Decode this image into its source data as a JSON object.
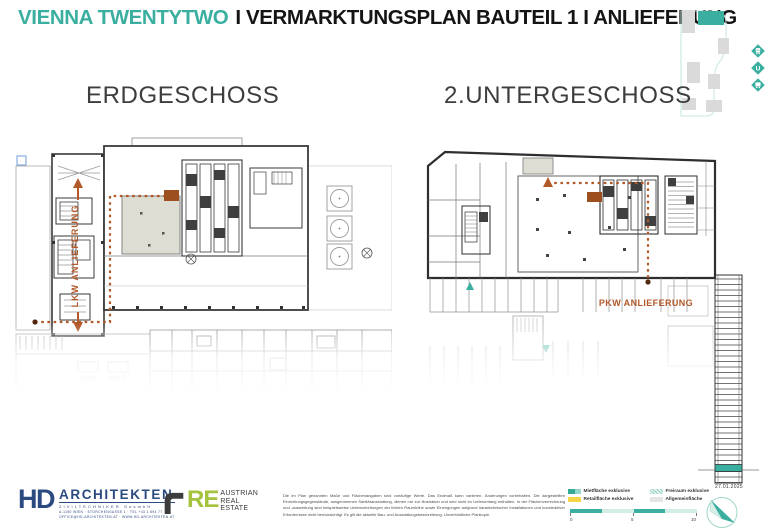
{
  "header": {
    "brand": "VIENNA TWENTYTWO",
    "title": "I VERMARKTUNGSPLAN BAUTEIL 1 I ANLIEFERUNG"
  },
  "site_map": {
    "ubahn_label": "U",
    "highlight_color": "#3aafa0"
  },
  "plans": {
    "left": {
      "title": "ERDGESCHOSS",
      "route_label": "LKW ANLIEFERUNG"
    },
    "right": {
      "title": "2.UNTERGESCHOSS",
      "route_label": "PKW ANLIEFERUNG"
    }
  },
  "route_color": "#b2592a",
  "level_indicator": {
    "date": "27.01.2025",
    "highlight_color": "#3aafa0"
  },
  "legend": {
    "items": [
      {
        "label": "Mietfläche exklusive",
        "color": "#3aafa0"
      },
      {
        "label": "Freiraum exklusive",
        "color": "#cdeae3"
      },
      {
        "label": "Retailfläche exklusive",
        "color": "#f6d648"
      },
      {
        "label": "Allgemeinfläche",
        "color": "#e4e4e4"
      }
    ]
  },
  "scale_bar": {
    "ticks": [
      "0",
      "5",
      "10"
    ]
  },
  "footer": {
    "hd": {
      "mark": "HD",
      "name": "ARCHITEKTEN",
      "subtitle": "ZIVILTECHNIKER GesmbH",
      "address1": "A-1150 WIEN · STORCHENGASSE 1 · TEL +43 1 894 77",
      "address2": "OFFICE@HD-ARCHITEKTEN.AT · WWW.HD-ARCHITEKTEN.AT"
    },
    "are": {
      "re": "RE",
      "line1": "AUSTRIAN",
      "line2": "REAL",
      "line3": "ESTATE"
    },
    "disclaimer": "Die im Plan genannten Maße und Flächenangaben sind vorläufige Werte. Das Endmaß kann variieren. Änderungen vorbehalten. Die dargestellten Einrichtungsgegenstände, ausgenommen Sanitärausstattung, dienen nur zur Illustration und sind nicht im Lieferumfang enthalten. In der Flächenverrechnung und -auswertung sind beispielsweise Unterschreitungen der lichten Raumhöhe sowie Einengungen aufgrund haustechnischer Installationen und konstruktiver Erfordernisse nicht berücksichtigt. Es gilt die aktuelle Bau- und Ausstattungsbeschreibung. Unverbindliche Plankopie."
  }
}
